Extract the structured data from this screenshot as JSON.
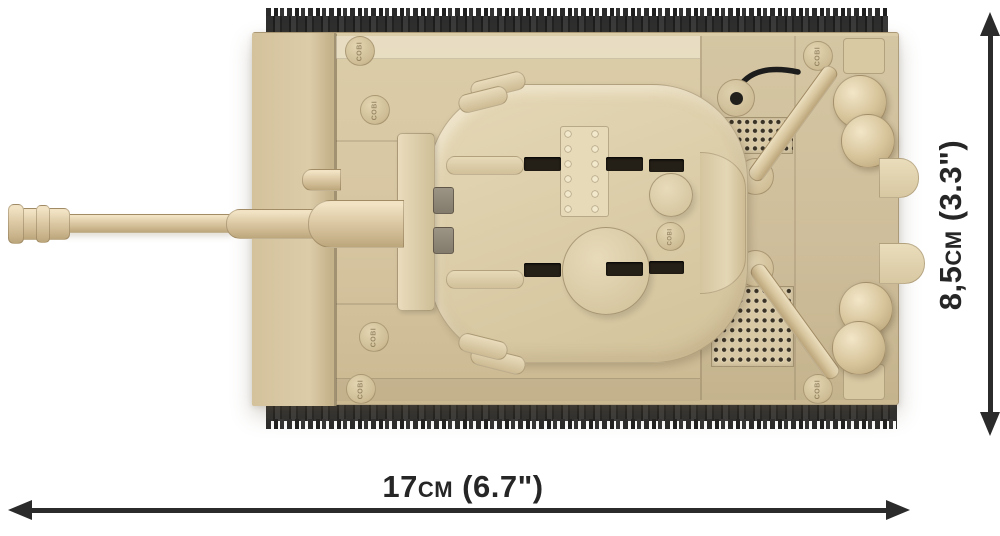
{
  "product": {
    "description": "COBI building-blocks tank model, top view",
    "brand_stud_text": "COBI"
  },
  "annotations": {
    "length": {
      "label": "17cm (6.7\")",
      "arrow": "double-headed-horizontal-arrow"
    },
    "width": {
      "label": "8,5cm (3.3\")",
      "arrow": "double-headed-vertical-arrow"
    }
  },
  "colors": {
    "brick_tan": "#d6c5a0",
    "brick_tan_light": "#e9dcbc",
    "brick_tan_dark": "#bca67c",
    "track_black": "#262626",
    "annotation_ink": "#2b2b2b",
    "background": "#ffffff"
  }
}
